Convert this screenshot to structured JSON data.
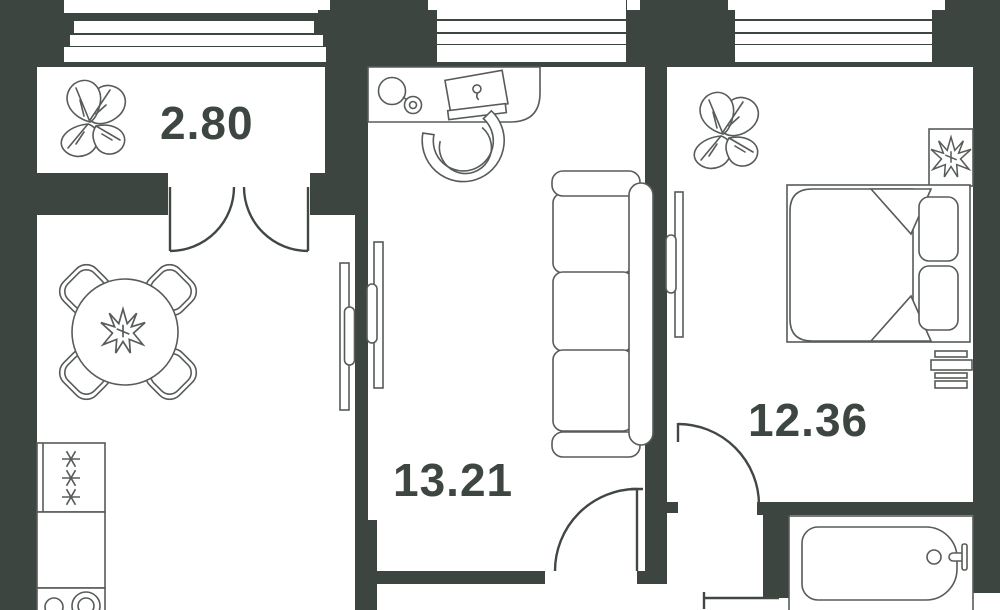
{
  "plan_title": "apartment-floor-plan",
  "colors": {
    "wall": "#3d4540",
    "furniture_line": "#575c58",
    "door_line": "#414843",
    "floor": "#ffffff",
    "label_text": "#3e4641"
  },
  "rooms": {
    "balcony": {
      "area": "2.80"
    },
    "living": {
      "area": "13.21"
    },
    "bedroom": {
      "area": "12.36"
    }
  },
  "features": {
    "balcony": [
      "monstera-plant"
    ],
    "kitchen_dining": [
      "round-dining-table",
      "dining-chairs-4",
      "table-centerpiece-plant",
      "fridge-with-snowflakes",
      "kitchen-counter",
      "stove-burners"
    ],
    "living": [
      "desk",
      "desk-lamp",
      "laptop",
      "office-chair",
      "three-seat-sofa",
      "sliding-door-panels"
    ],
    "bedroom": [
      "monstera-plant",
      "double-bed",
      "blanket-fold-corners",
      "pillows-2",
      "dresser",
      "plant-on-stand"
    ],
    "bathroom": [
      "bathtub",
      "faucet",
      "drain"
    ],
    "doors": [
      "balcony-french-door",
      "living-room-door",
      "bedroom-door",
      "hall-opening"
    ]
  }
}
